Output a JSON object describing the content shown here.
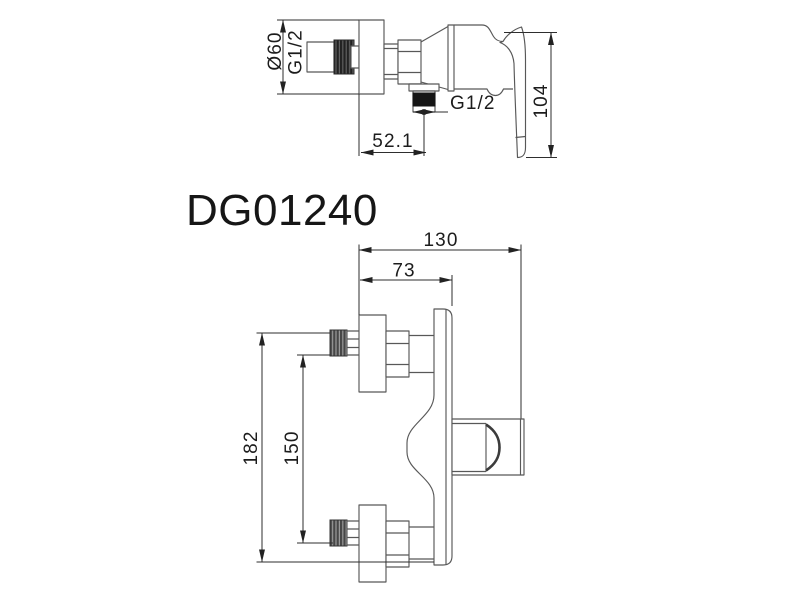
{
  "drawing": {
    "model_number": "DG01240",
    "side_view": {
      "dim_plate_diameter": "Ø60",
      "dim_inlet_thread": "G1/2",
      "dim_outlet_thread": "G1/2",
      "dim_height": "104",
      "dim_wall_to_outlet": "52.1"
    },
    "front_view": {
      "dim_overall_width": "130",
      "dim_body_depth": "73",
      "dim_overall_height": "182",
      "dim_ports_spacing": "150"
    },
    "colors": {
      "line": "#585858",
      "dimension": "#2e2e2e",
      "text": "#1c1c1c",
      "thread_dark": "#1e1e1e",
      "background": "#ffffff"
    }
  }
}
